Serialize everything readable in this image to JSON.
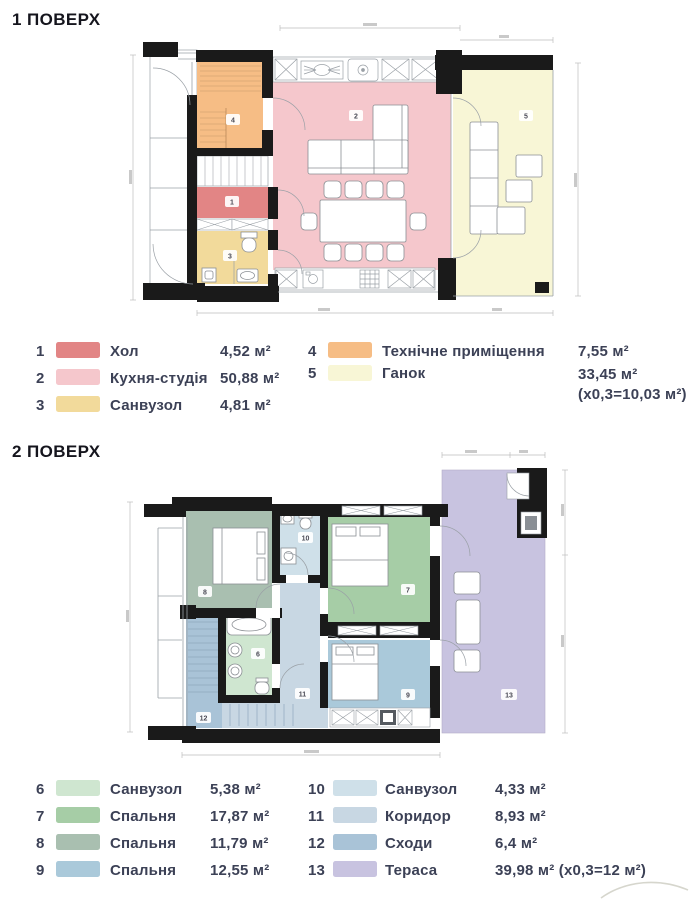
{
  "floor1": {
    "heading": "1 ПОВЕРХ",
    "legend": {
      "left": [
        {
          "num": "1",
          "label": "Хол",
          "area": "4,52 м²",
          "color": "#e28585"
        },
        {
          "num": "2",
          "label": "Кухня-студія",
          "area": "50,88 м²",
          "color": "#f5c7cc"
        },
        {
          "num": "3",
          "label": "Санвузол",
          "area": "4,81 м²",
          "color": "#f2da9b"
        }
      ],
      "right": [
        {
          "num": "4",
          "label": "Технічне приміщення",
          "area": "7,55 м²",
          "color": "#f6bd85"
        },
        {
          "num": "5",
          "label": "Ганок",
          "area": "33,45 м²",
          "area2": "(х0,3=10,03 м²)",
          "color": "#f8f6d6"
        }
      ]
    }
  },
  "floor2": {
    "heading": "2 ПОВЕРХ",
    "legend": {
      "left": [
        {
          "num": "6",
          "label": "Санвузол",
          "area": "5,38 м²",
          "color": "#cfe6d0"
        },
        {
          "num": "7",
          "label": "Спальня",
          "area": "17,87 м²",
          "color": "#a6cda6"
        },
        {
          "num": "8",
          "label": "Спальня",
          "area": "11,79 м²",
          "color": "#a9bfb0"
        },
        {
          "num": "9",
          "label": "Спальня",
          "area": "12,55 м²",
          "color": "#aac9da"
        }
      ],
      "right": [
        {
          "num": "10",
          "label": "Санвузол",
          "area": "4,33 м²",
          "color": "#cfe0e9"
        },
        {
          "num": "11",
          "label": "Коридор",
          "area": "8,93 м²",
          "color": "#c8d7e3"
        },
        {
          "num": "12",
          "label": "Сходи",
          "area": "6,4 м²",
          "color": "#a9c3d7"
        },
        {
          "num": "13",
          "label": "Тераса",
          "area": "39,98 м² (х0,3=12 м²)",
          "color": "#c8c3e0"
        }
      ]
    }
  }
}
